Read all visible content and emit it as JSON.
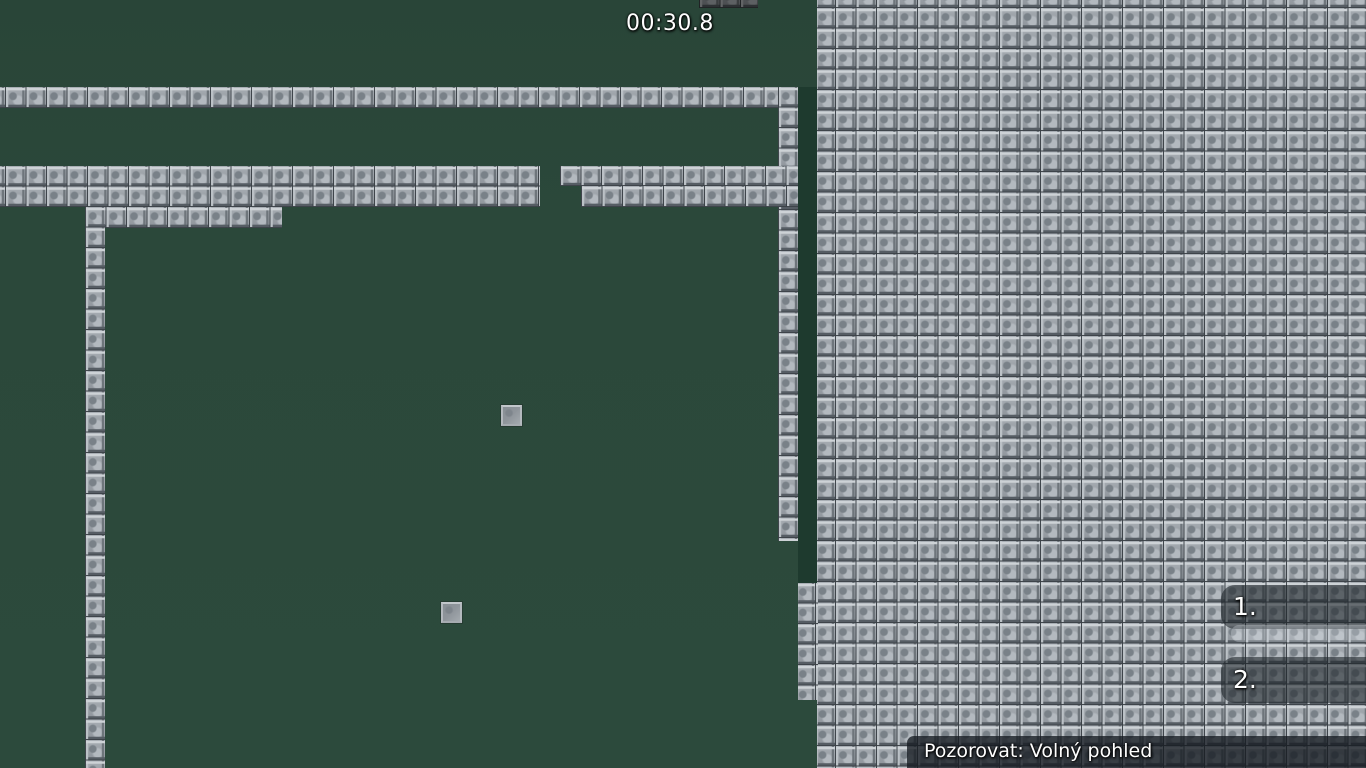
{
  "hud": {
    "timer": "00:30.8",
    "scoreboard": [
      {
        "rank": "1."
      },
      {
        "rank": "2."
      }
    ],
    "spectate_label": "Pozorovat: Volný pohled"
  },
  "colors": {
    "field_green": "#2b483a",
    "field_shadow_green": "#1e3a2e",
    "tile_gray": "#9aa0a6",
    "tile_gap": "#3a4046",
    "hud_panel": "rgba(30,36,42,0.58)",
    "hud_highlight_band": "rgba(214,220,226,0.33)",
    "hud_bar": "rgba(22,27,33,0.78)",
    "hud_text": "#ffffff"
  },
  "map": {
    "tile_size": 20.5,
    "shadow_strip": {
      "x": 798,
      "y": 87,
      "w": 20,
      "h": 496
    },
    "wall_segments": [
      {
        "x": 817,
        "y": 0,
        "w": 549,
        "h": 768,
        "ox": -2.5,
        "oy": -12.5
      },
      {
        "x": 798,
        "y": 583,
        "w": 20,
        "h": 117,
        "ox": -3,
        "oy": 0
      },
      {
        "x": 0,
        "y": 87,
        "w": 798,
        "h": 21,
        "ox": -15.5,
        "oy": 0
      },
      {
        "x": 778,
        "y": 87,
        "w": 20,
        "h": 454,
        "ox": 0,
        "oy": 0
      },
      {
        "x": 0,
        "y": 166,
        "w": 540,
        "h": 41,
        "ox": -15.5,
        "oy": 0
      },
      {
        "x": 560,
        "y": 166,
        "w": 238,
        "h": 20,
        "ox": 0,
        "oy": 0
      },
      {
        "x": 581,
        "y": 186,
        "w": 217,
        "h": 21,
        "ox": 0,
        "oy": 0
      },
      {
        "x": 85,
        "y": 207,
        "w": 197,
        "h": 21,
        "ox": 0,
        "oy": 0
      },
      {
        "x": 85,
        "y": 207,
        "w": 20,
        "h": 561,
        "ox": 0,
        "oy": 0
      }
    ],
    "shadowed_wall_segments": [
      {
        "x": 699,
        "y": 0,
        "w": 59,
        "h": 8,
        "ox": 0,
        "oy": -12.5
      }
    ],
    "item_tiles": [
      {
        "x": 501,
        "y": 405
      },
      {
        "x": 441,
        "y": 602
      }
    ]
  }
}
